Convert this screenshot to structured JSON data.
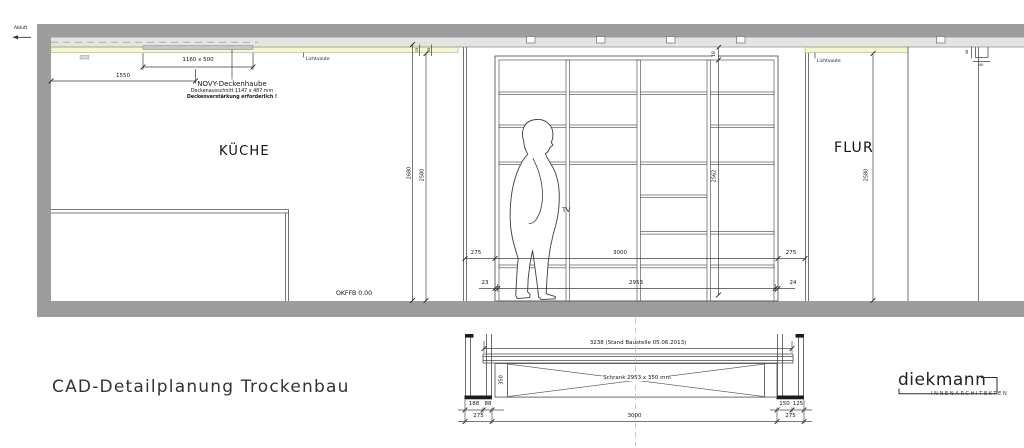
{
  "page": {
    "title": "CAD-Detailplanung Trockenbau"
  },
  "logo": {
    "name": "diekmann",
    "subtitle": "INNENARCHITEKTEN"
  },
  "rooms": {
    "kitchen": "KÜCHE",
    "hall": "FLUR"
  },
  "ceiling": {
    "abluft": "Abluft",
    "lichtvoute_left": "Lichtvoute",
    "lichtvoute_right": "Lichtvoute",
    "hood_name": "NOVY-Deckenhaube",
    "hood_cutout": "Deckenausschnitt 1147 x 487 mm",
    "hood_note": "Deckenverstärkung erforderlich !",
    "hood_size": "1160 x 500",
    "hood_offset": "1550",
    "voute_d1": "15",
    "voute_d2": "35",
    "corner_d1": "48",
    "corner_d2": "40"
  },
  "heights": {
    "kitchen_raw": "2680",
    "kitchen_clear": "2580",
    "shelf_gap": "18",
    "shelf": "2562",
    "hall_clear": "2580"
  },
  "floor": {
    "okffb": "OKFFB 0.00"
  },
  "shelf": {
    "tv": "TV",
    "side_left": "275",
    "opening": "3000",
    "side_right": "275",
    "panel_left": "23",
    "inner": "2953",
    "panel_right": "24"
  },
  "section": {
    "total": "3238 (Stand Baustelle 05.06.2013)",
    "cabinet": "Schrank 2953 x 350 mm",
    "depth": "350",
    "wall_left_a": "188",
    "wall_left_b": "88",
    "wall_left_total": "275",
    "width": "3000",
    "wall_right_a": "150",
    "wall_right_b": "125",
    "wall_right_total": "275"
  }
}
